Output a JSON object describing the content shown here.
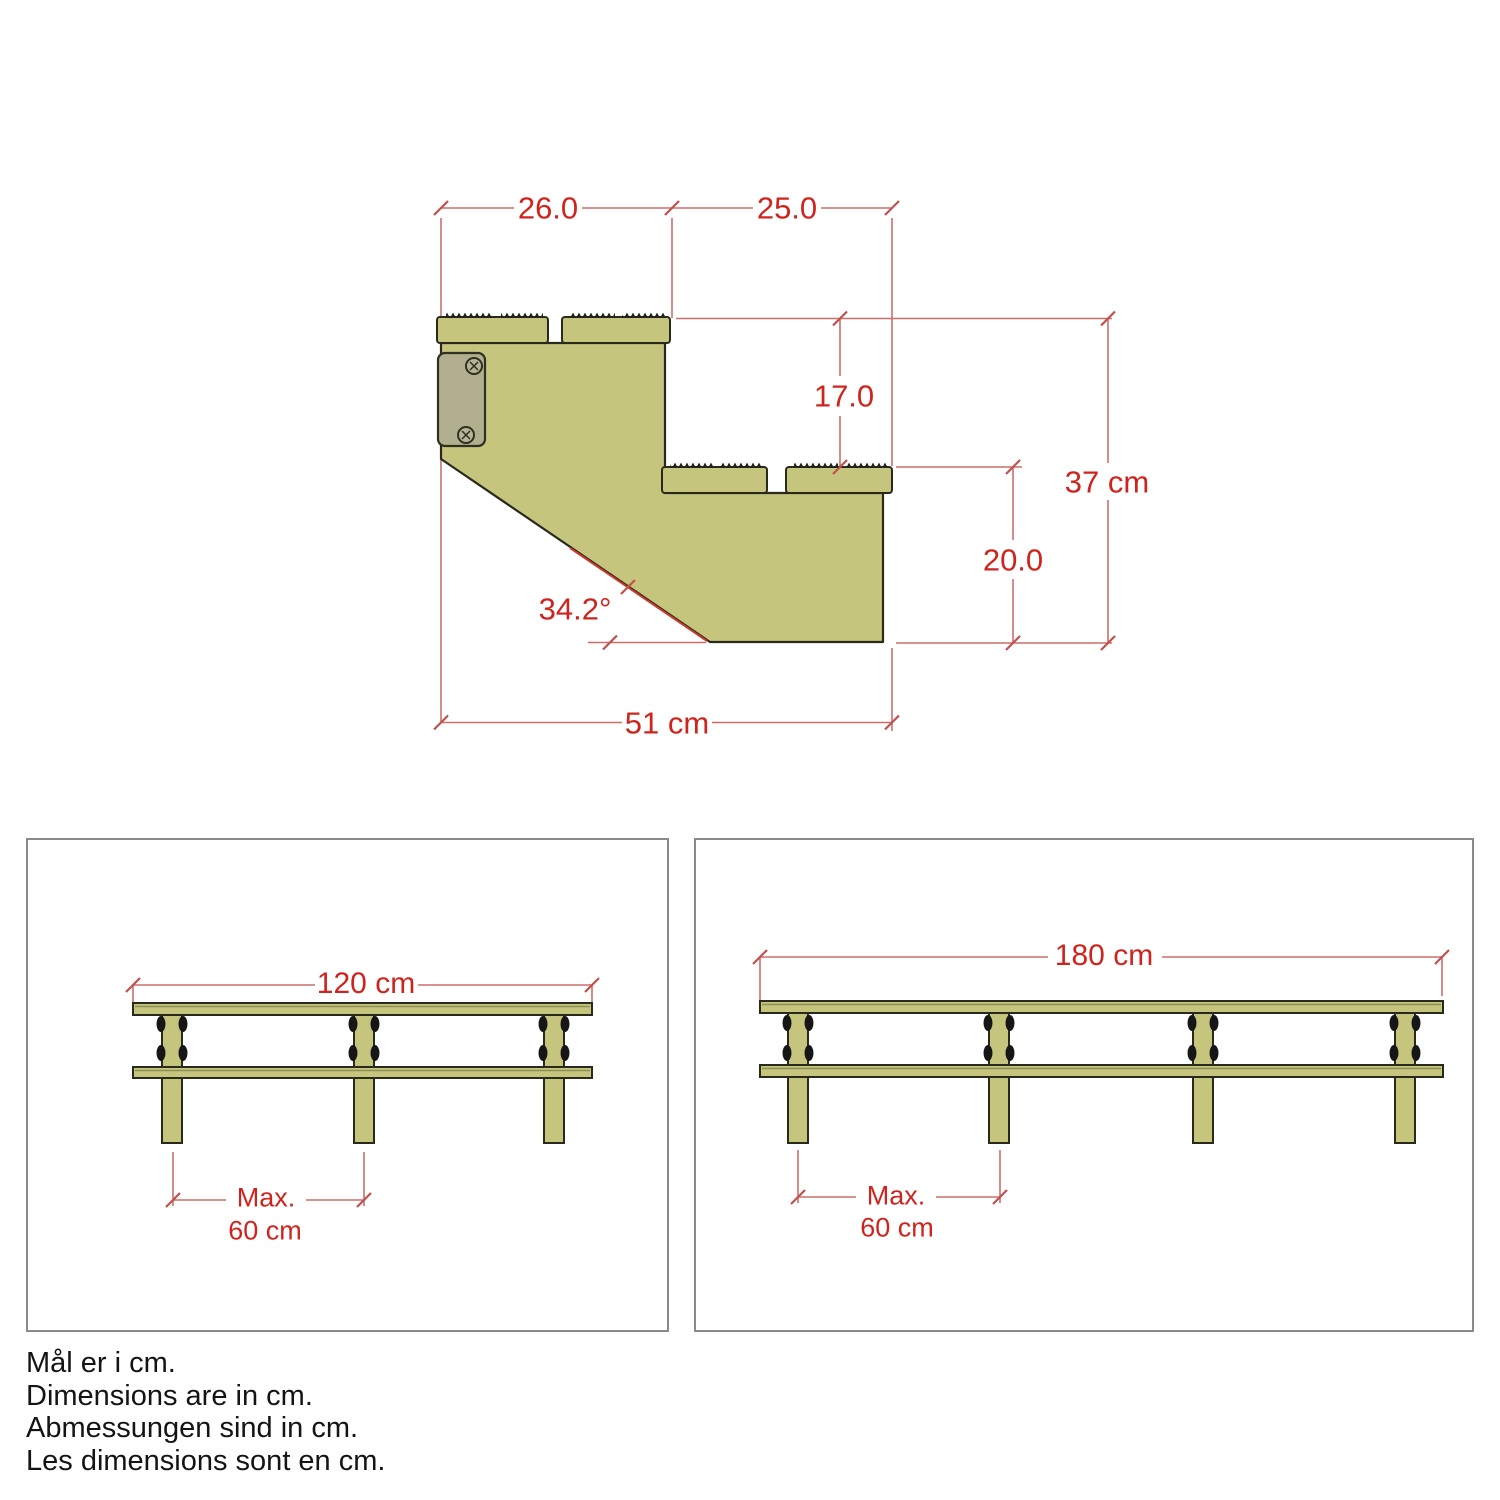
{
  "title": "Stair stringer dimension drawing",
  "colors": {
    "wood_fill": "#c6c57d",
    "wood_outline": "#2a2a1c",
    "plate_fill": "#b2af8e",
    "dimension_line": "#cb6f6b",
    "dimension_text": "#cf241d",
    "panel_border": "#8a8a8a",
    "fitting_black": "#161616"
  },
  "stringer_view": {
    "dim_top_step_depth": "26.0",
    "dim_second_step_depth": "25.0",
    "dim_step_rise": "17.0",
    "dim_total_height": "37 cm",
    "dim_lower_rise": "20.0",
    "dim_angle": "34.2°",
    "dim_total_depth": "51 cm"
  },
  "front_views": {
    "left": {
      "width_label": "120 cm",
      "post_count": 3,
      "spacing_prefix": "Max.",
      "spacing_value": "60 cm"
    },
    "right": {
      "width_label": "180 cm",
      "post_count": 4,
      "spacing_prefix": "Max.",
      "spacing_value": "60 cm"
    }
  },
  "notes": [
    "Mål er i cm.",
    "Dimensions are in cm.",
    "Abmessungen sind in cm.",
    "Les dimensions sont en cm."
  ]
}
